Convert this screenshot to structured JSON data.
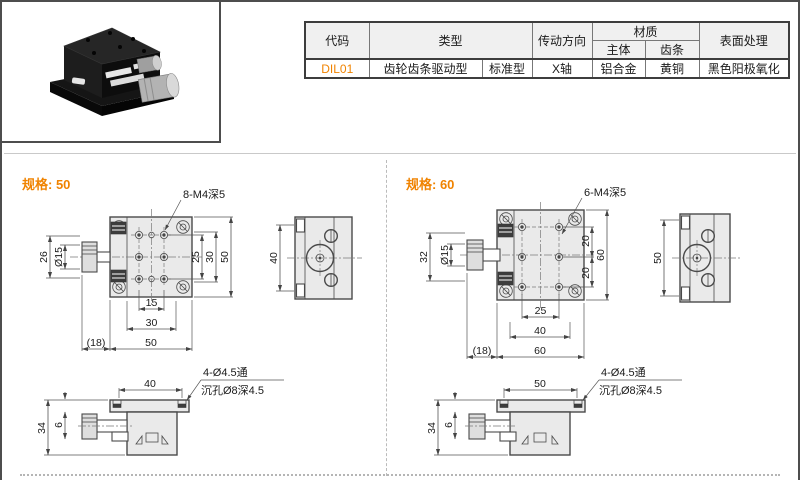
{
  "table": {
    "headers": {
      "code": "代码",
      "type": "类型",
      "direction": "传动方向",
      "material": "材质",
      "body": "主体",
      "rack": "齿条",
      "surface": "表面处理"
    },
    "row": {
      "code": "DIL01",
      "type_main": "齿轮齿条驱动型",
      "type_sub": "标准型",
      "direction": "X轴",
      "body": "铝合金",
      "rack": "黄铜",
      "surface": "黑色阳极氧化"
    }
  },
  "spec50": {
    "title": "规格: 50",
    "hole_label": "8-M4深5",
    "top": {
      "left_height": "26",
      "knob_dia": "Ø15",
      "right_inner": "25",
      "right_mid": "30",
      "right_outer": "50",
      "bottom_inner": "15",
      "bottom_mid": "30",
      "knob_len": "(18)",
      "bottom_outer": "50"
    },
    "side": {
      "height": "40"
    },
    "front": {
      "width": "40",
      "thru": "4-Ø4.5通",
      "cbore": "沉孔Ø8深4.5",
      "height": "34",
      "offset": "6"
    }
  },
  "spec60": {
    "title": "规格: 60",
    "hole_label": "6-M4深5",
    "top": {
      "left_height": "32",
      "knob_dia": "Ø15",
      "right_top": "20",
      "right_bottom": "20",
      "right_outer": "60",
      "bottom_inner": "25",
      "bottom_mid": "40",
      "knob_len": "(18)",
      "bottom_outer": "60"
    },
    "side": {
      "height": "50"
    },
    "front": {
      "width": "50",
      "thru": "4-Ø4.5通",
      "cbore": "沉孔Ø8深4.5",
      "height": "34",
      "offset": "6"
    }
  }
}
